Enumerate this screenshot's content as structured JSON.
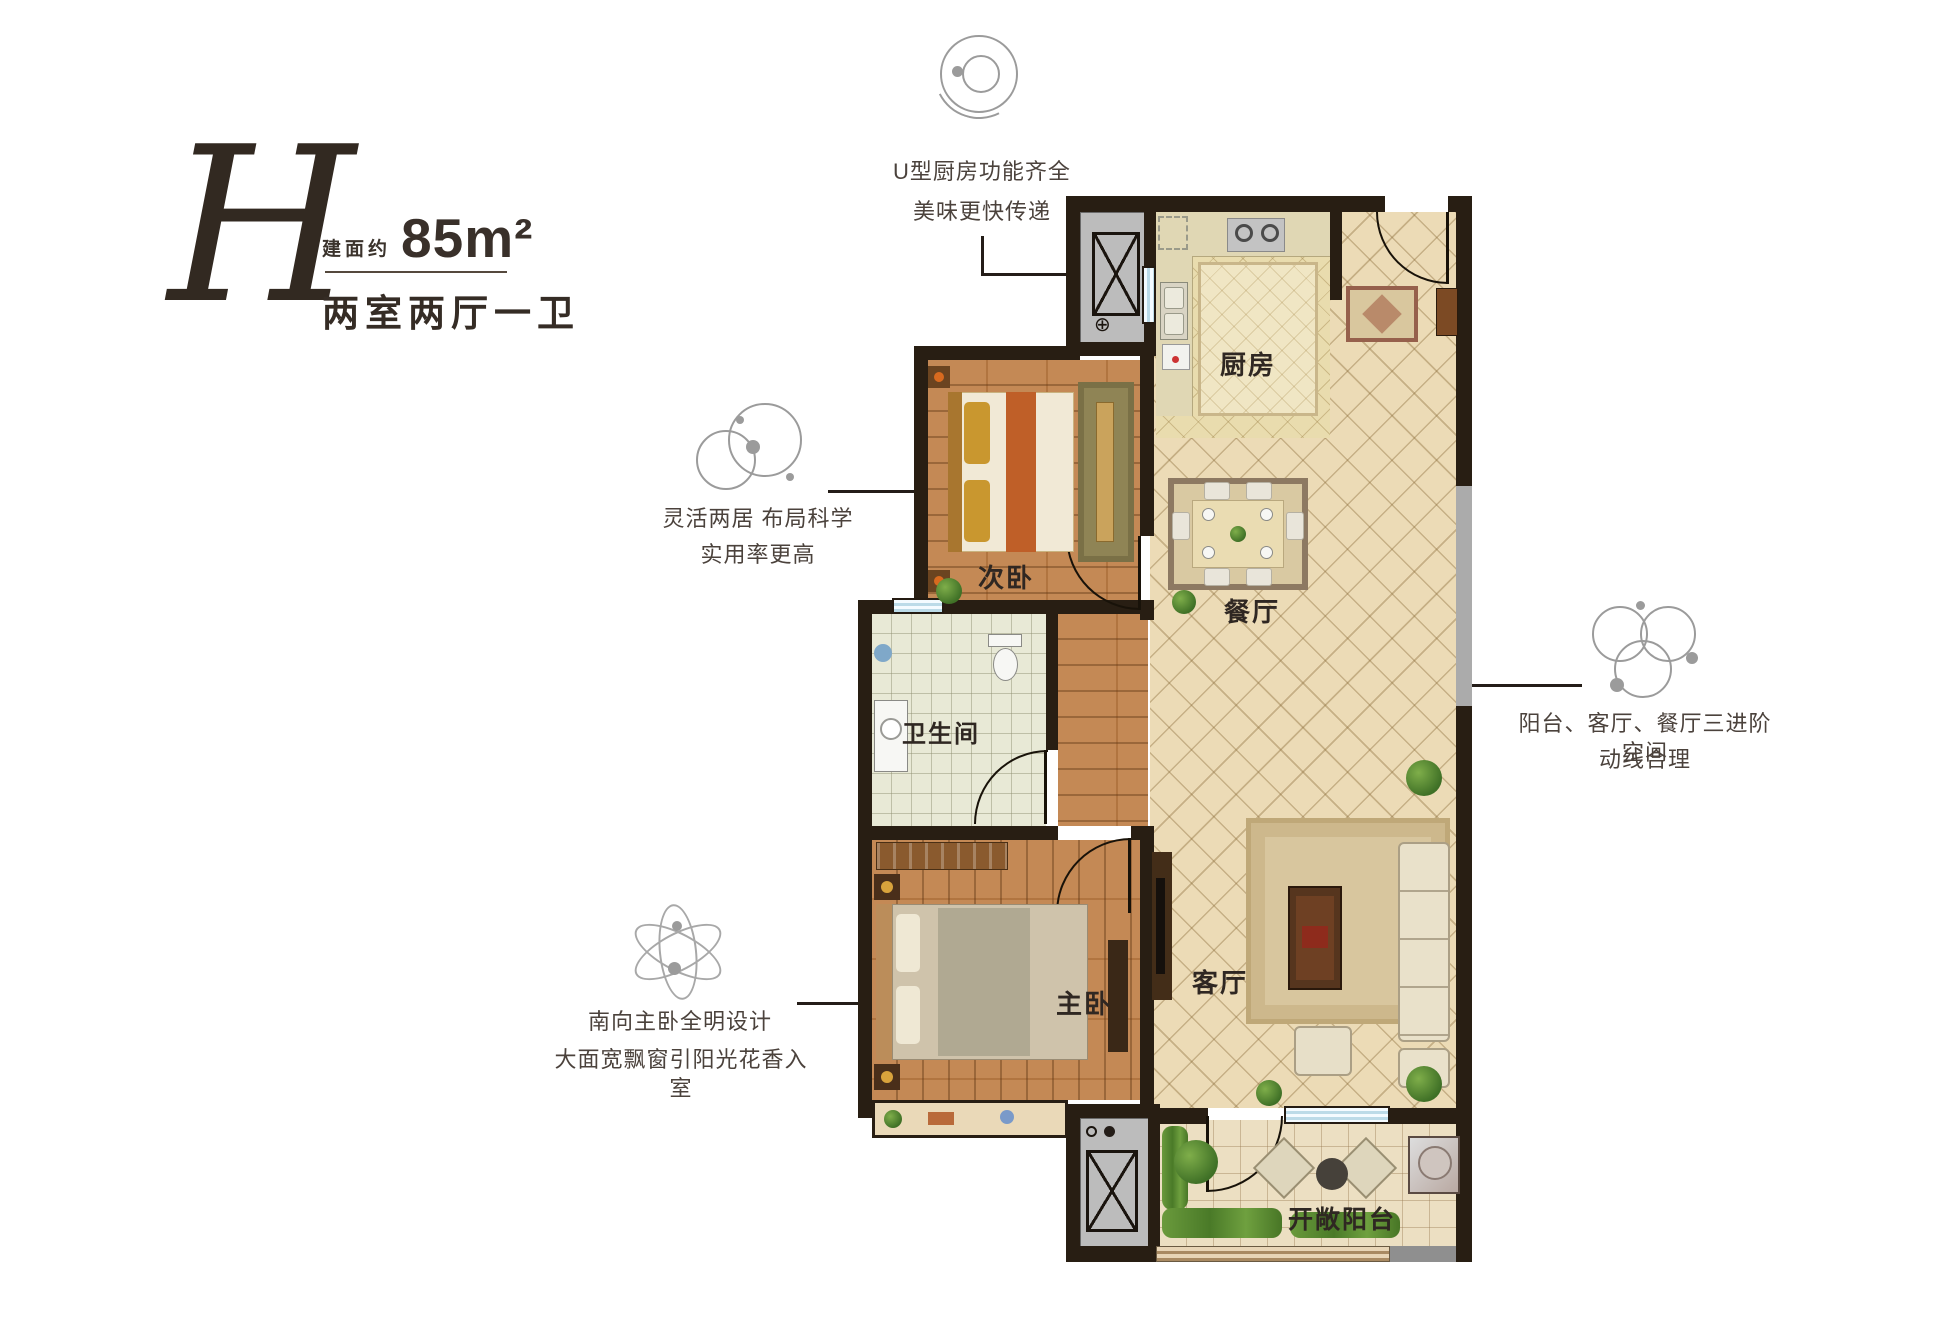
{
  "title": {
    "letter": "H",
    "area_label": "建面约",
    "area_value": "85m²",
    "layout_type": "两室两厅一卫"
  },
  "annotations": {
    "kitchen": {
      "line1": "U型厨房功能齐全",
      "line2": "美味更快传递"
    },
    "bedrooms": {
      "line1": "灵活两居 布局科学",
      "line2": "实用率更高"
    },
    "circulation": {
      "line1": "阳台、客厅、餐厅三进阶空间",
      "line2": "动线合理"
    },
    "master": {
      "line1": "南向主卧全明设计",
      "line2": "大面宽飘窗引阳光花香入室"
    }
  },
  "rooms": {
    "kitchen": "厨房",
    "second_bedroom": "次卧",
    "dining": "餐厅",
    "bathroom": "卫生间",
    "master_bedroom": "主卧",
    "living": "客厅",
    "balcony": "开敞阳台"
  },
  "symbols": {
    "drain_cross": "⊕"
  },
  "colors": {
    "wall": "#281e13",
    "wood_floor": "#c08048",
    "hall_tile": "#ecdbb6",
    "window_blue": "#bcdbe8",
    "icon_gray": "#9b9b9b",
    "text_dark": "#332a24"
  }
}
